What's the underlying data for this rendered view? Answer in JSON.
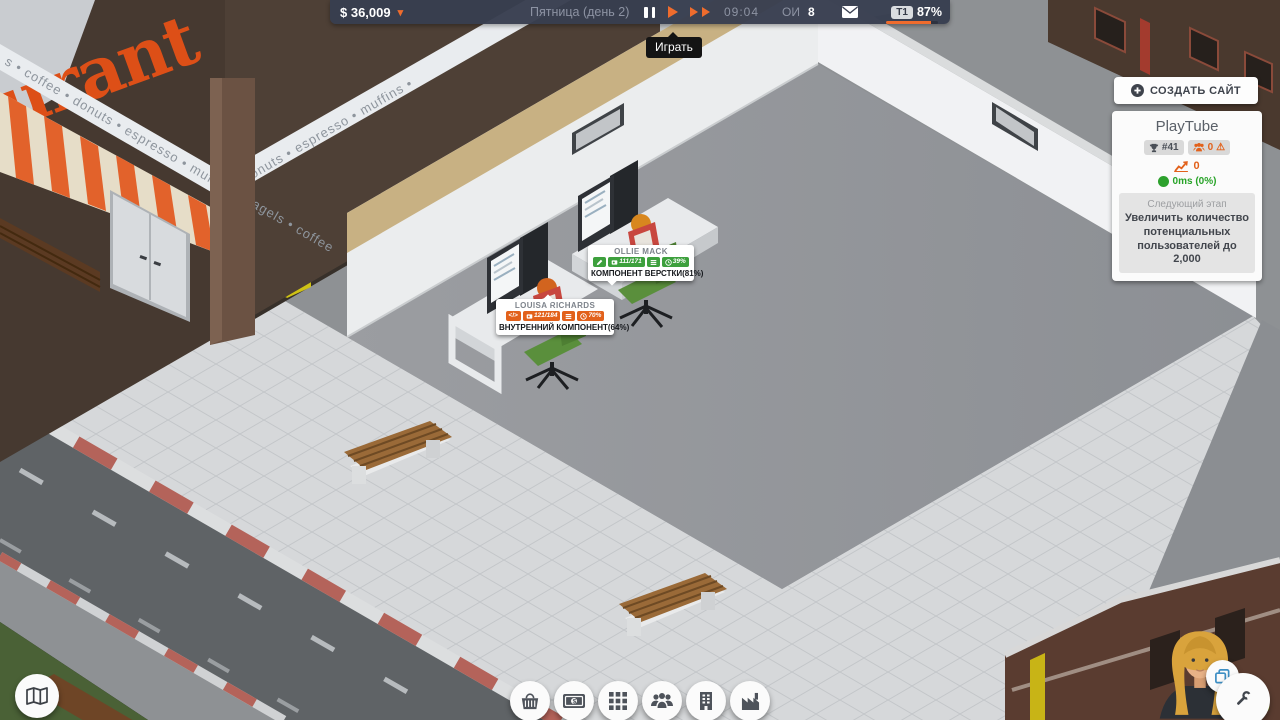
{
  "top_bar": {
    "money": "$ 36,009",
    "date": "Пятница (день 2)",
    "time": "09:04",
    "research_label": "ОИ",
    "research_value": "8",
    "tier_label": "T1",
    "tier_percent": "87%",
    "tier_progress": 87,
    "play_tooltip": "Играть"
  },
  "right_panel": {
    "create_site_button": "СОЗДАТЬ САЙТ",
    "site_card": {
      "name": "PlayTube",
      "rank": "#41",
      "users": "0",
      "trend": "0",
      "latency": "0ms (0%)",
      "next_stage_label": "Следующий этап",
      "next_stage_text": "Увеличить количество потенциальных пользователей до 2,000"
    }
  },
  "employees": [
    {
      "name": "OLLIE MACK",
      "progress": "111/171",
      "percent": "39%",
      "task": "КОМПОНЕНТ ВЕРСТКИ(81%)",
      "status_color": "#3da03d"
    },
    {
      "name": "LOUISA RICHARDS",
      "progress": "121/184",
      "percent": "70%",
      "task": "ВНУТРЕННИЙ КОМПОНЕНТ(64%)",
      "status_color": "#e2611b"
    }
  ],
  "icons": {
    "chevron_down": "▾",
    "warning": "⚠",
    "code": "</>"
  },
  "scene": {
    "restaurant_sign": "urant",
    "restaurant_band_left": "s • coffee • donuts • espresso • muffins • bagels • coffee",
    "restaurant_band_right": "• donuts • espresso • muffins •",
    "fps": "60"
  },
  "colors": {
    "accent_orange": "#ef6c2d",
    "green": "#3da03d",
    "badge_orange": "#e2611b"
  }
}
